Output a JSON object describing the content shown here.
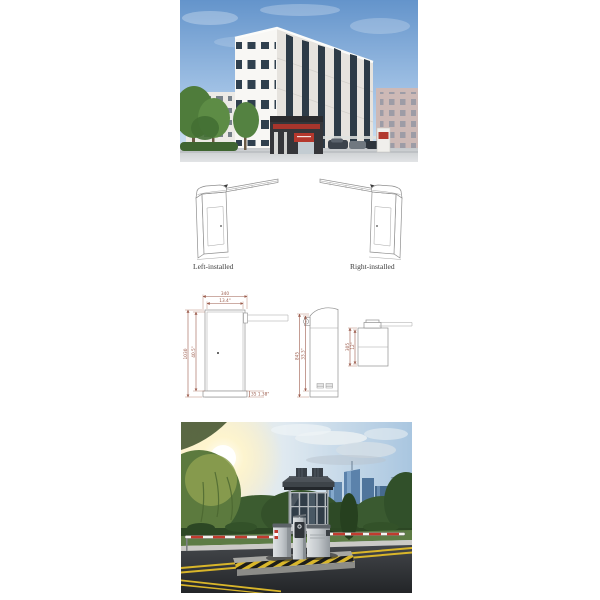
{
  "installation": {
    "left_label": "Left-installed",
    "right_label": "Right-installed"
  },
  "dimensions": {
    "front": {
      "width_mm": "340",
      "width_in": "13.4\"",
      "height_mm": "1030",
      "height_in": "40.5\"",
      "base": "35 1.38\""
    },
    "side": {
      "height_mm": "845",
      "height_in": "33.3\""
    },
    "top": {
      "depth_mm": "305",
      "depth_in": "12\""
    }
  },
  "photos": {
    "factory": {
      "description": "White multi-storey factory building under blue sky with trees, cars and red entrance signs"
    },
    "barrier_scene": {
      "description": "Parking entrance at sunset: guard booth, barrier gate cabinets with red-white boom arms, yellow-black island, double yellow road lines, city skyline"
    }
  },
  "colors": {
    "background": "#ffffff",
    "dimension_line": "#9c5c4c",
    "drawing_line": "#8f8f8f",
    "barrier_red": "#c23b2e",
    "warning_yellow": "#d9b62a",
    "sky_blue": "#6494cb"
  }
}
